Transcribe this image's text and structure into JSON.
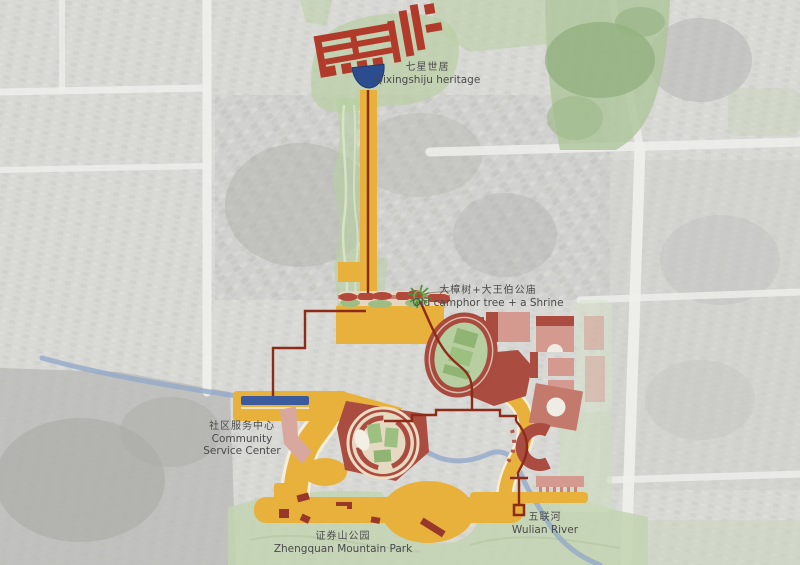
{
  "labels": {
    "qixingshiju": {
      "zh": "七星世居",
      "en": "Qixingshiju heritage"
    },
    "camphor": {
      "zh": "大樟树+大王伯公庙",
      "en": "Old camphor tree + a Shrine"
    },
    "community": {
      "zh": "社区服务中心",
      "en_line1": "Community",
      "en_line2": "Service Center"
    },
    "park": {
      "zh": "证券山公园",
      "en": "Zhengquan Mountain Park"
    },
    "river": {
      "zh": "五联河",
      "en": "Wulian River"
    }
  },
  "colors": {
    "path_yellow": "#e7b13c",
    "path_casing": "#f6eed9",
    "route_red": "#8c2b17",
    "heritage_red": "#b23a2a",
    "building_dark_red": "#ab4c40",
    "building_light_pink": "#d49a90",
    "pond_blue": "#2c4c90",
    "canal_blue": "#3b5b9d",
    "river_blue": "#93a9c9",
    "green_overlay": "#b9cfa3",
    "park_green": "#c3d3b2",
    "field_green": "#b7cfa0",
    "label_text": "#4a4a4a"
  }
}
